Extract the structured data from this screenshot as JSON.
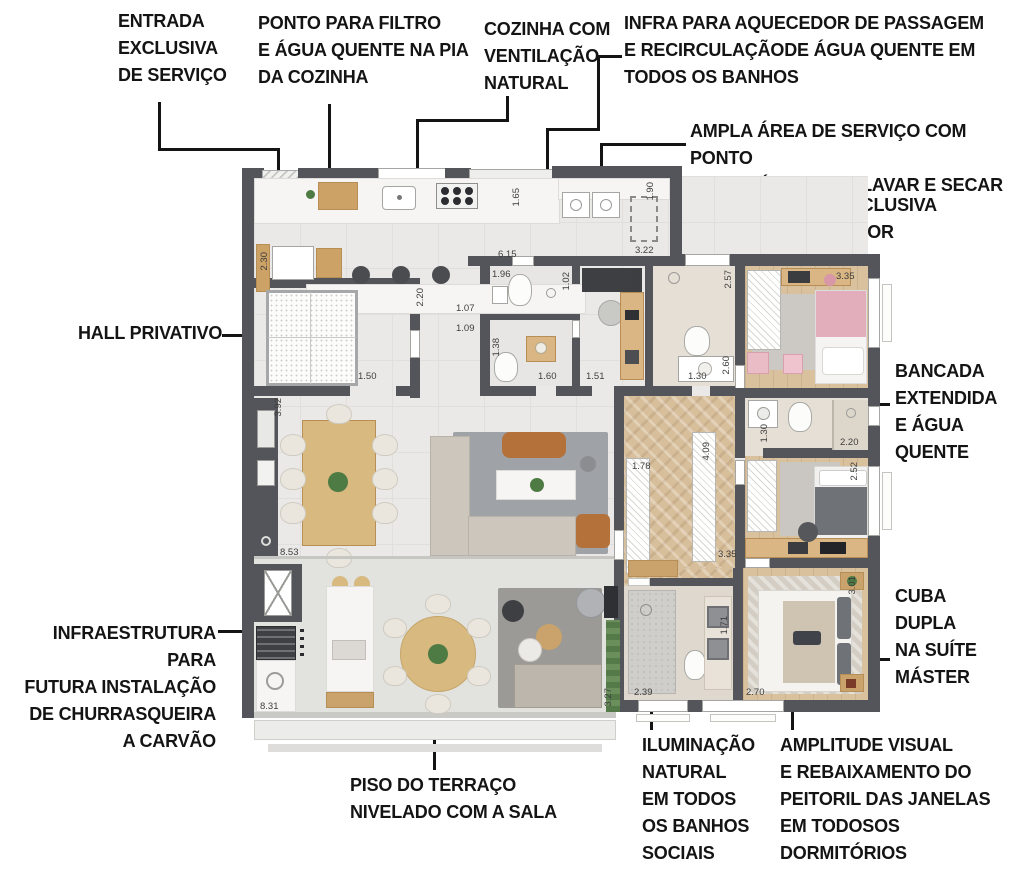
{
  "annotations": {
    "entrada": "ENTRADA\nEXCLUSIVA\nDE SERVIÇO",
    "ponto_filtro": "PONTO PARA FILTRO\nE ÁGUA QUENTE NA PIA\nDA COZINHA",
    "cozinha": "COZINHA COM\nVENTILAÇÃO\nNATURAL",
    "infra_aquecedor": "INFRA PARA AQUECEDOR DE PASSAGEM\nE RECIRCULAÇÃODE ÁGUA QUENTE EM\nTODOS OS BANHOS",
    "ampla_area": "AMPLA ÁREA DE SERVIÇO COM PONTO\nPARA MÁQUINA DE LAVAR E SECAR",
    "area_tecnica": "ÁREA TÉCNICA EXCLUSIVA\nPARA CONDENSADOR",
    "hall": "HALL PRIVATIVO",
    "bancada": "BANCADA\nEXTENDIDA\nE ÁGUA\nQUENTE",
    "cuba": "CUBA\nDUPLA\nNA SUÍTE\nMÁSTER",
    "churrasqueira": "INFRAESTRUTURA PARA\nFUTURA INSTALAÇÃO\nDE CHURRASQUEIRA\nA CARVÃO",
    "piso": "PISO DO TERRAÇO\nNIVELADO COM A SALA",
    "iluminacao": "ILUMINAÇÃO\nNATURAL\nEM TODOS\nOS BANHOS\nSOCIAIS",
    "amplitude": "AMPLITUDE VISUAL\nE REBAIXAMENTO DO\nPEITORIL DAS JANELAS\nEM TODOSOS\nDORMITÓRIOS"
  },
  "dims": {
    "d_190": "1.90",
    "d_322": "3.22",
    "d_165": "1.65",
    "d_230": "2.30",
    "d_220a": "2.20",
    "d_615": "6.15",
    "d_196": "1.96",
    "d_102": "1.02",
    "d_260a": "2.60",
    "d_257": "2.57",
    "d_335a": "3.35",
    "d_107": "1.07",
    "d_109": "1.09",
    "d_138": "1.38",
    "d_160": "1.60",
    "d_151": "1.51",
    "d_130a": "1.30",
    "d_260b": "2.60",
    "d_150": "1.50",
    "d_392": "3.92",
    "d_853": "8.53",
    "d_178": "1.78",
    "d_409": "4.09",
    "d_130b": "1.30",
    "d_220b": "2.20",
    "d_252": "2.52",
    "d_335b": "3.35",
    "d_301": "3.01",
    "d_171": "1.71",
    "d_270": "2.70",
    "d_239": "2.39",
    "d_831": "8.31",
    "d_327": "3.27"
  },
  "colors": {
    "wall": "#54555a",
    "wood": "#cda267",
    "marble": "#f6f5f3",
    "pink_accent": "#e3aebc",
    "gray_bed": "#6f7277",
    "plant_green": "#4e7a43",
    "leather": "#b5713a",
    "annotation_text": "#141414"
  }
}
